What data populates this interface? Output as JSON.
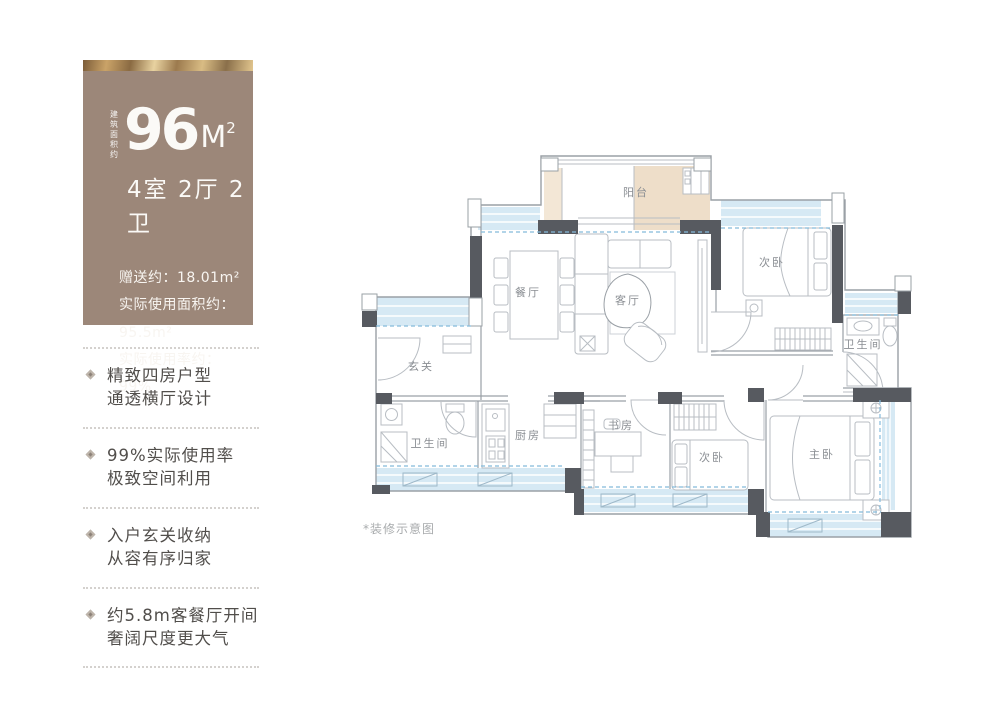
{
  "card": {
    "area_caption": "建筑面积约",
    "area_value": "96",
    "area_unit": "M",
    "area_sup": "2",
    "layout": "4室 2厅 2卫",
    "stats": [
      "赠送约：18.01m²",
      "实际使用面积约：95.5m²",
      "实际使用率约：99%"
    ]
  },
  "features": [
    {
      "line1": "精致四房户型",
      "line2": "通透横厅设计"
    },
    {
      "line1": "99%实际使用率",
      "line2": "极致空间利用"
    },
    {
      "line1": "入户玄关收纳",
      "line2": "从容有序归家"
    },
    {
      "line1": "约5.8m客餐厅开间",
      "line2": "奢阔尺度更大气"
    }
  ],
  "floor_plan": {
    "note": "*装修示意图",
    "rooms": [
      {
        "label": "阳台"
      },
      {
        "label": "餐厅"
      },
      {
        "label": "客厅"
      },
      {
        "label": "次卧"
      },
      {
        "label": "卫生间"
      },
      {
        "label": "玄关"
      },
      {
        "label": "卫生间"
      },
      {
        "label": "厨房"
      },
      {
        "label": "书房"
      },
      {
        "label": "次卧"
      },
      {
        "label": "主卧"
      }
    ]
  },
  "colors": {
    "card_bg": "#9c8779",
    "gold_band": "#caa368",
    "wall_dark": "#575a60",
    "window_blue": "#d6e9f4",
    "balcony_tan": "#eedec9",
    "label_gray": "#8a8e93"
  }
}
